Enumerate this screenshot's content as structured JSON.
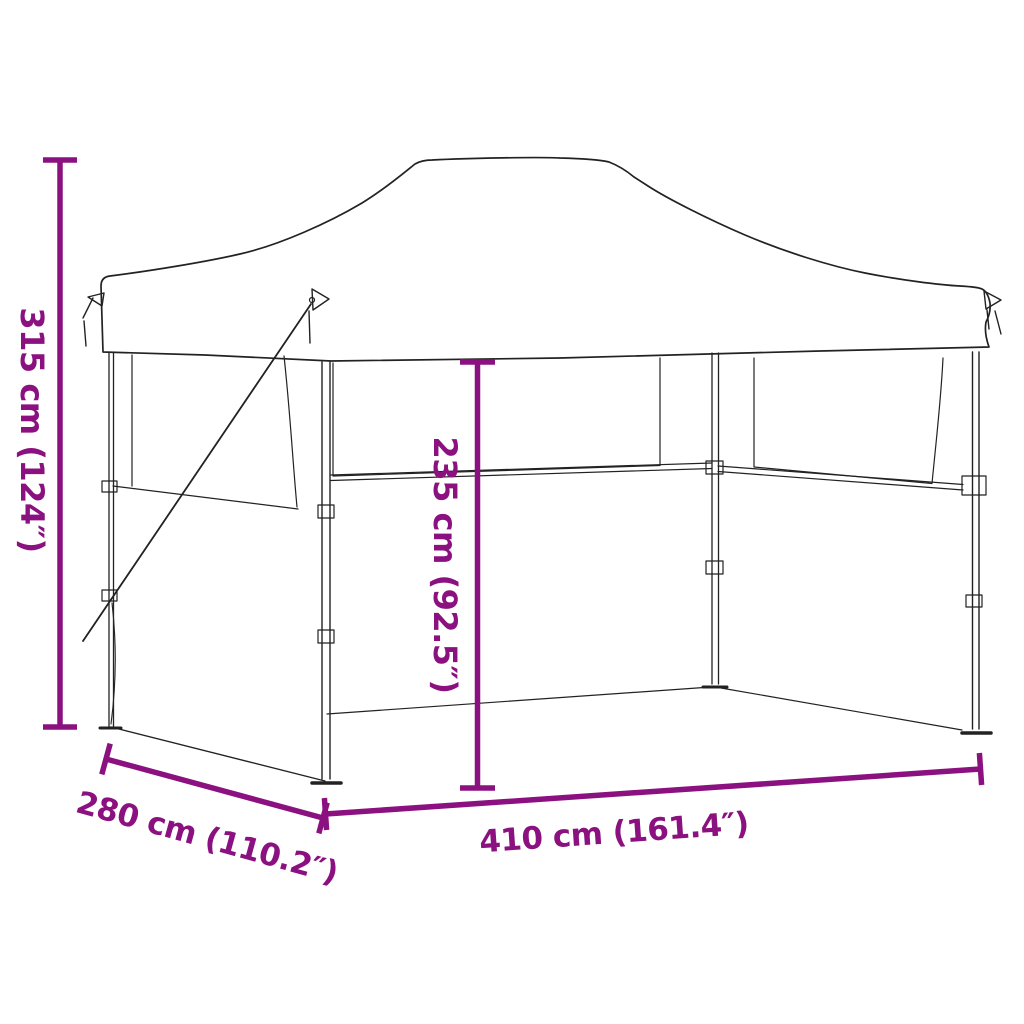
{
  "figure": {
    "type": "product-dimension-diagram",
    "subject": "pop-up folding party tent (gazebo) with sidewalls, line drawing with measurements"
  },
  "colors": {
    "dimension_accent": "#8A117F",
    "drawing_line": "#222222",
    "background": "#FFFFFF"
  },
  "labels": {
    "total_height": "315 cm (124″)",
    "inner_height": "235 cm (92.5″)",
    "width": "410 cm (161.4″)",
    "depth": "280 cm (110.2″)"
  }
}
